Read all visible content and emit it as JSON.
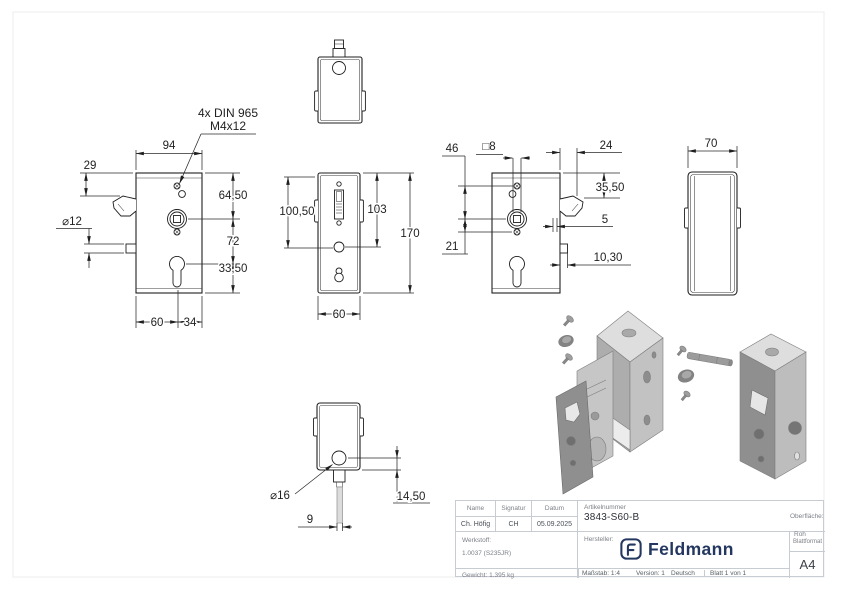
{
  "drawing": {
    "note": {
      "line1": "4x DIN 965",
      "line2": "M4x12"
    },
    "front_view": {
      "width": "94",
      "flange_offset": "29",
      "bolt_dia": "⌀12",
      "top_to_spindle": "64,50",
      "spindle_to_cylinder": "72",
      "cylinder_to_bottom": "33,50",
      "bottom_left": "60",
      "bottom_right": "34"
    },
    "side_view": {
      "inner_height": "100,50",
      "mid_height": "103",
      "total_height": "170",
      "depth": "60"
    },
    "back_view": {
      "hole_spacing": "46",
      "square": "□8",
      "latch_depth": "24",
      "top_to_latch": "35,50",
      "latch_offset": "5",
      "spindle_to_hole": "21",
      "tab_depth": "10,30"
    },
    "side_view2": {
      "width": "70"
    },
    "bottom_view": {
      "pin_dia": "⌀16",
      "pin_offset": "14,50",
      "pin_width": "9"
    }
  },
  "titleblock": {
    "col_name": "Name",
    "col_signatur": "Signatur",
    "col_datum": "Datum",
    "name": "Ch. Höfig",
    "signatur": "CH",
    "datum": "05.09.2025",
    "artikel_label": "Artikelnummer",
    "artikelnummer": "3843-S60-B",
    "oberflaeche_label": "Oberfläche:",
    "oberflaeche": "Roh",
    "werkstoff_label": "Werkstoff:",
    "werkstoff": "1.0037 (S235JR)",
    "gewicht": "Gewicht: 1.395 kg",
    "hersteller_label": "Hersteller:",
    "brand": "Feldmann",
    "brand_color": "#24375f",
    "massstab": "Maßstab: 1:4",
    "version": "Version: 1",
    "sprache": "Deutsch",
    "blatt": "Blatt 1 von 1",
    "blattformat_label": "Blattformat",
    "blattformat": "A4"
  }
}
